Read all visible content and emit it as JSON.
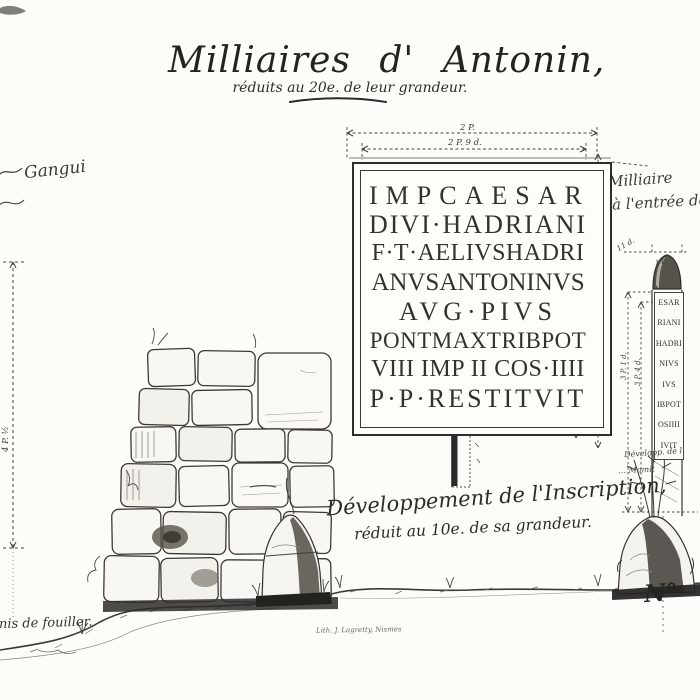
{
  "plate": {
    "title": "Milliaires d' Antonin,",
    "subtitle": "réduits au 20e. de leur grandeur."
  },
  "annotations": {
    "top_left_fragment": "Gangui",
    "top_right_1": "Milliaire",
    "top_right_2": "à l'entrée de",
    "caption_1": "Développement de l'Inscription,",
    "caption_2": "réduit au 10e. de sa grandeur.",
    "side_note_1": "Développ. de l",
    "side_note_2": "… Mamit",
    "bottom_left_fragment": "…nis de fouiller.",
    "imprint": "Lith. J. Lagretty, Nismes",
    "numero": "N°"
  },
  "measurements": {
    "tablet_width_outer": "2 P.",
    "tablet_width_inner": "2 P. 9 d.",
    "tablet_height_1": "3 P. 4 p. 9 d.",
    "tablet_height_2": "3 P. 9 p. 11 d.",
    "left_column_height": "4 P. ½",
    "milestone_top": "11 d.",
    "milestone_cap": "1 P.",
    "milestone_height_1": "3 P. 1 d.",
    "milestone_height_2": "3 P. 4 d."
  },
  "inscription": {
    "lines": [
      "IMPCAESAR",
      "DIVI·HADRIANI",
      "F·T·AELIVSHADRI",
      "ANVSANTONINVS",
      "AVG·PIVS",
      "PONTMAXTRIBPOT",
      "VIII IMP II COS·IIII",
      "P·P·RESTITVIT"
    ]
  },
  "milestone_inscription": {
    "lines": [
      "ESAR",
      "RIANI",
      "HADRI",
      "NIVS",
      "IVS",
      "IBPOT",
      "OSIIII",
      "IVIT"
    ]
  },
  "colors": {
    "paper": "#fcfcf9",
    "ink": "#2f2f2e",
    "ink_light": "#6b6962"
  }
}
